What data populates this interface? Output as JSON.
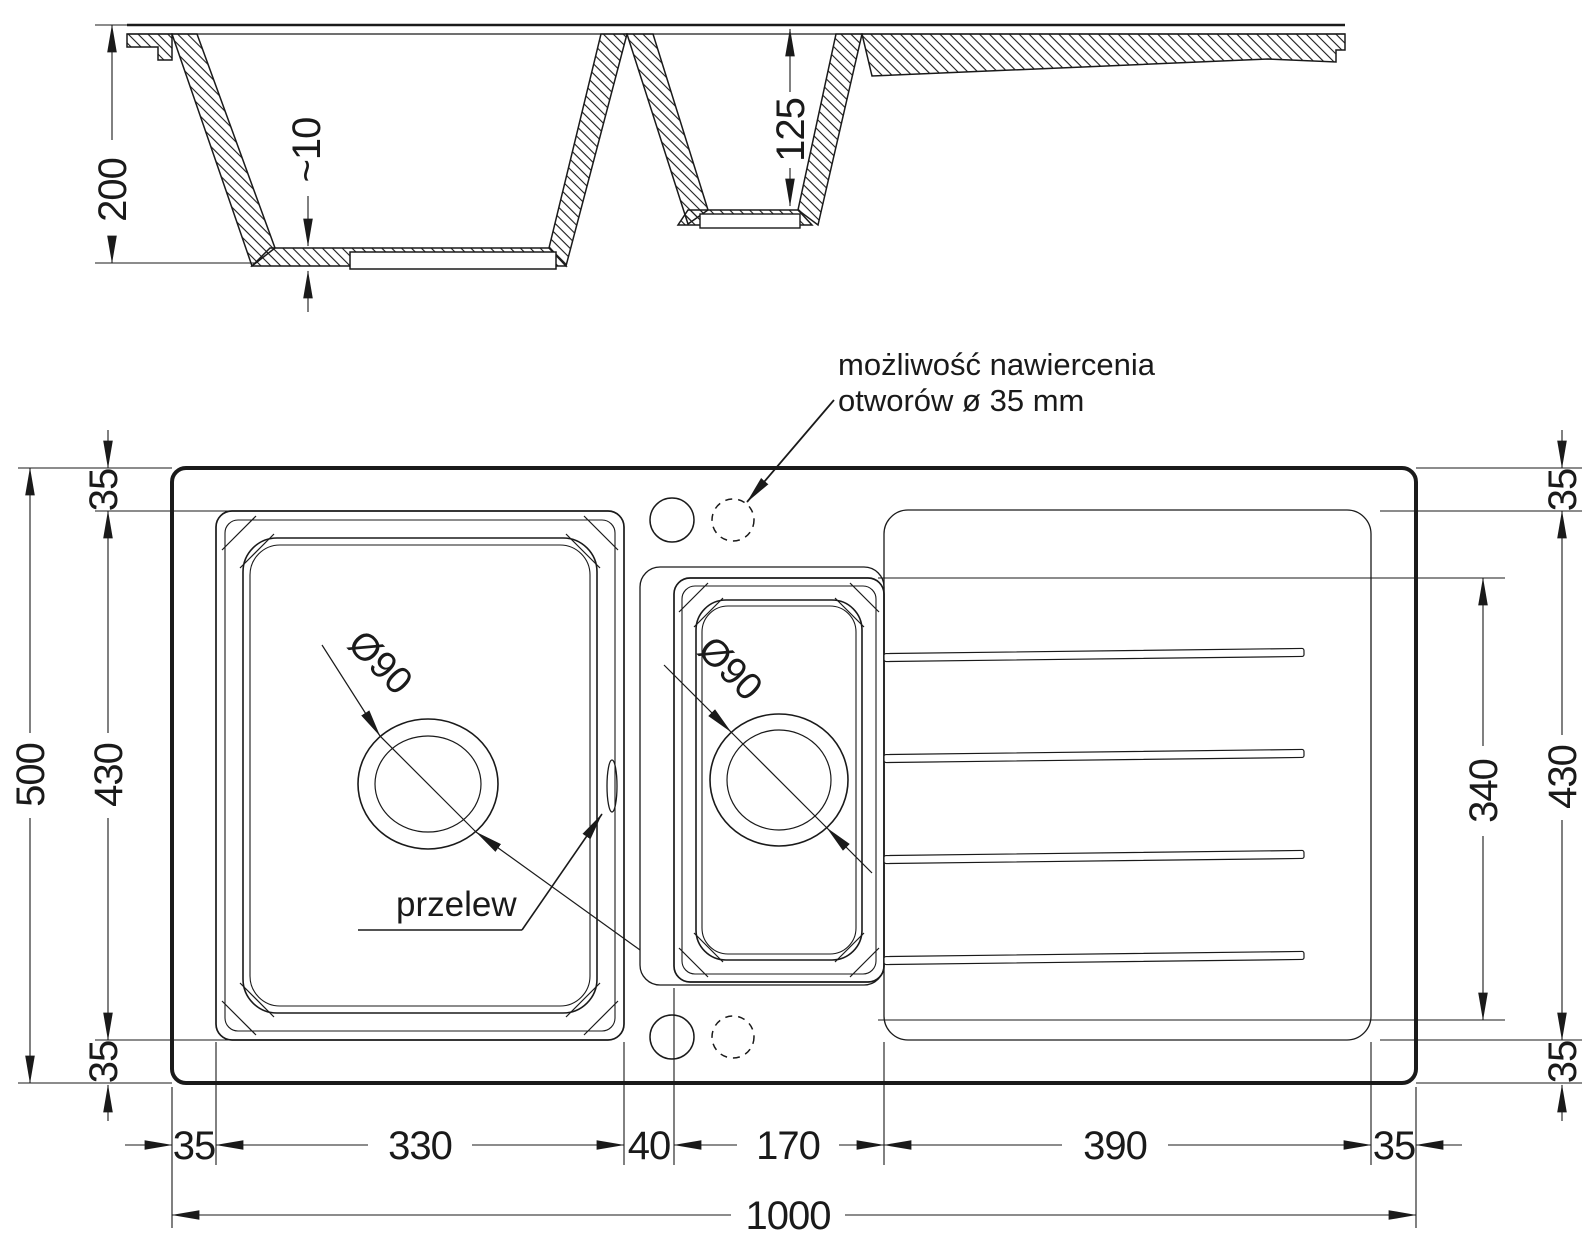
{
  "drawing": {
    "section_view": {
      "depth_total": "200",
      "bottom_thickness": "~10",
      "small_bowl_depth": "125"
    },
    "plan_view": {
      "annotation_line1": "możliwość nawiercenia",
      "annotation_line2": "otworów ø 35 mm",
      "overflow_label": "przelew",
      "main_drain_diameter": "Ø90",
      "small_drain_diameter": "Ø90",
      "dims": {
        "total_width": "1000",
        "total_height": "500",
        "left_top_margin": "35",
        "left_bowl_height": "430",
        "left_bottom_margin": "35",
        "right_top_margin": "35",
        "right_bowl_height": "430",
        "right_bottom_margin": "35",
        "drainer_groove_height": "340",
        "bottom_margin_left": "35",
        "main_bowl_width": "330",
        "divider_width": "40",
        "small_bowl_width": "170",
        "drainer_width": "390",
        "bottom_margin_right": "35"
      }
    },
    "colors": {
      "line": "#1a1a1a",
      "background": "#ffffff"
    }
  }
}
